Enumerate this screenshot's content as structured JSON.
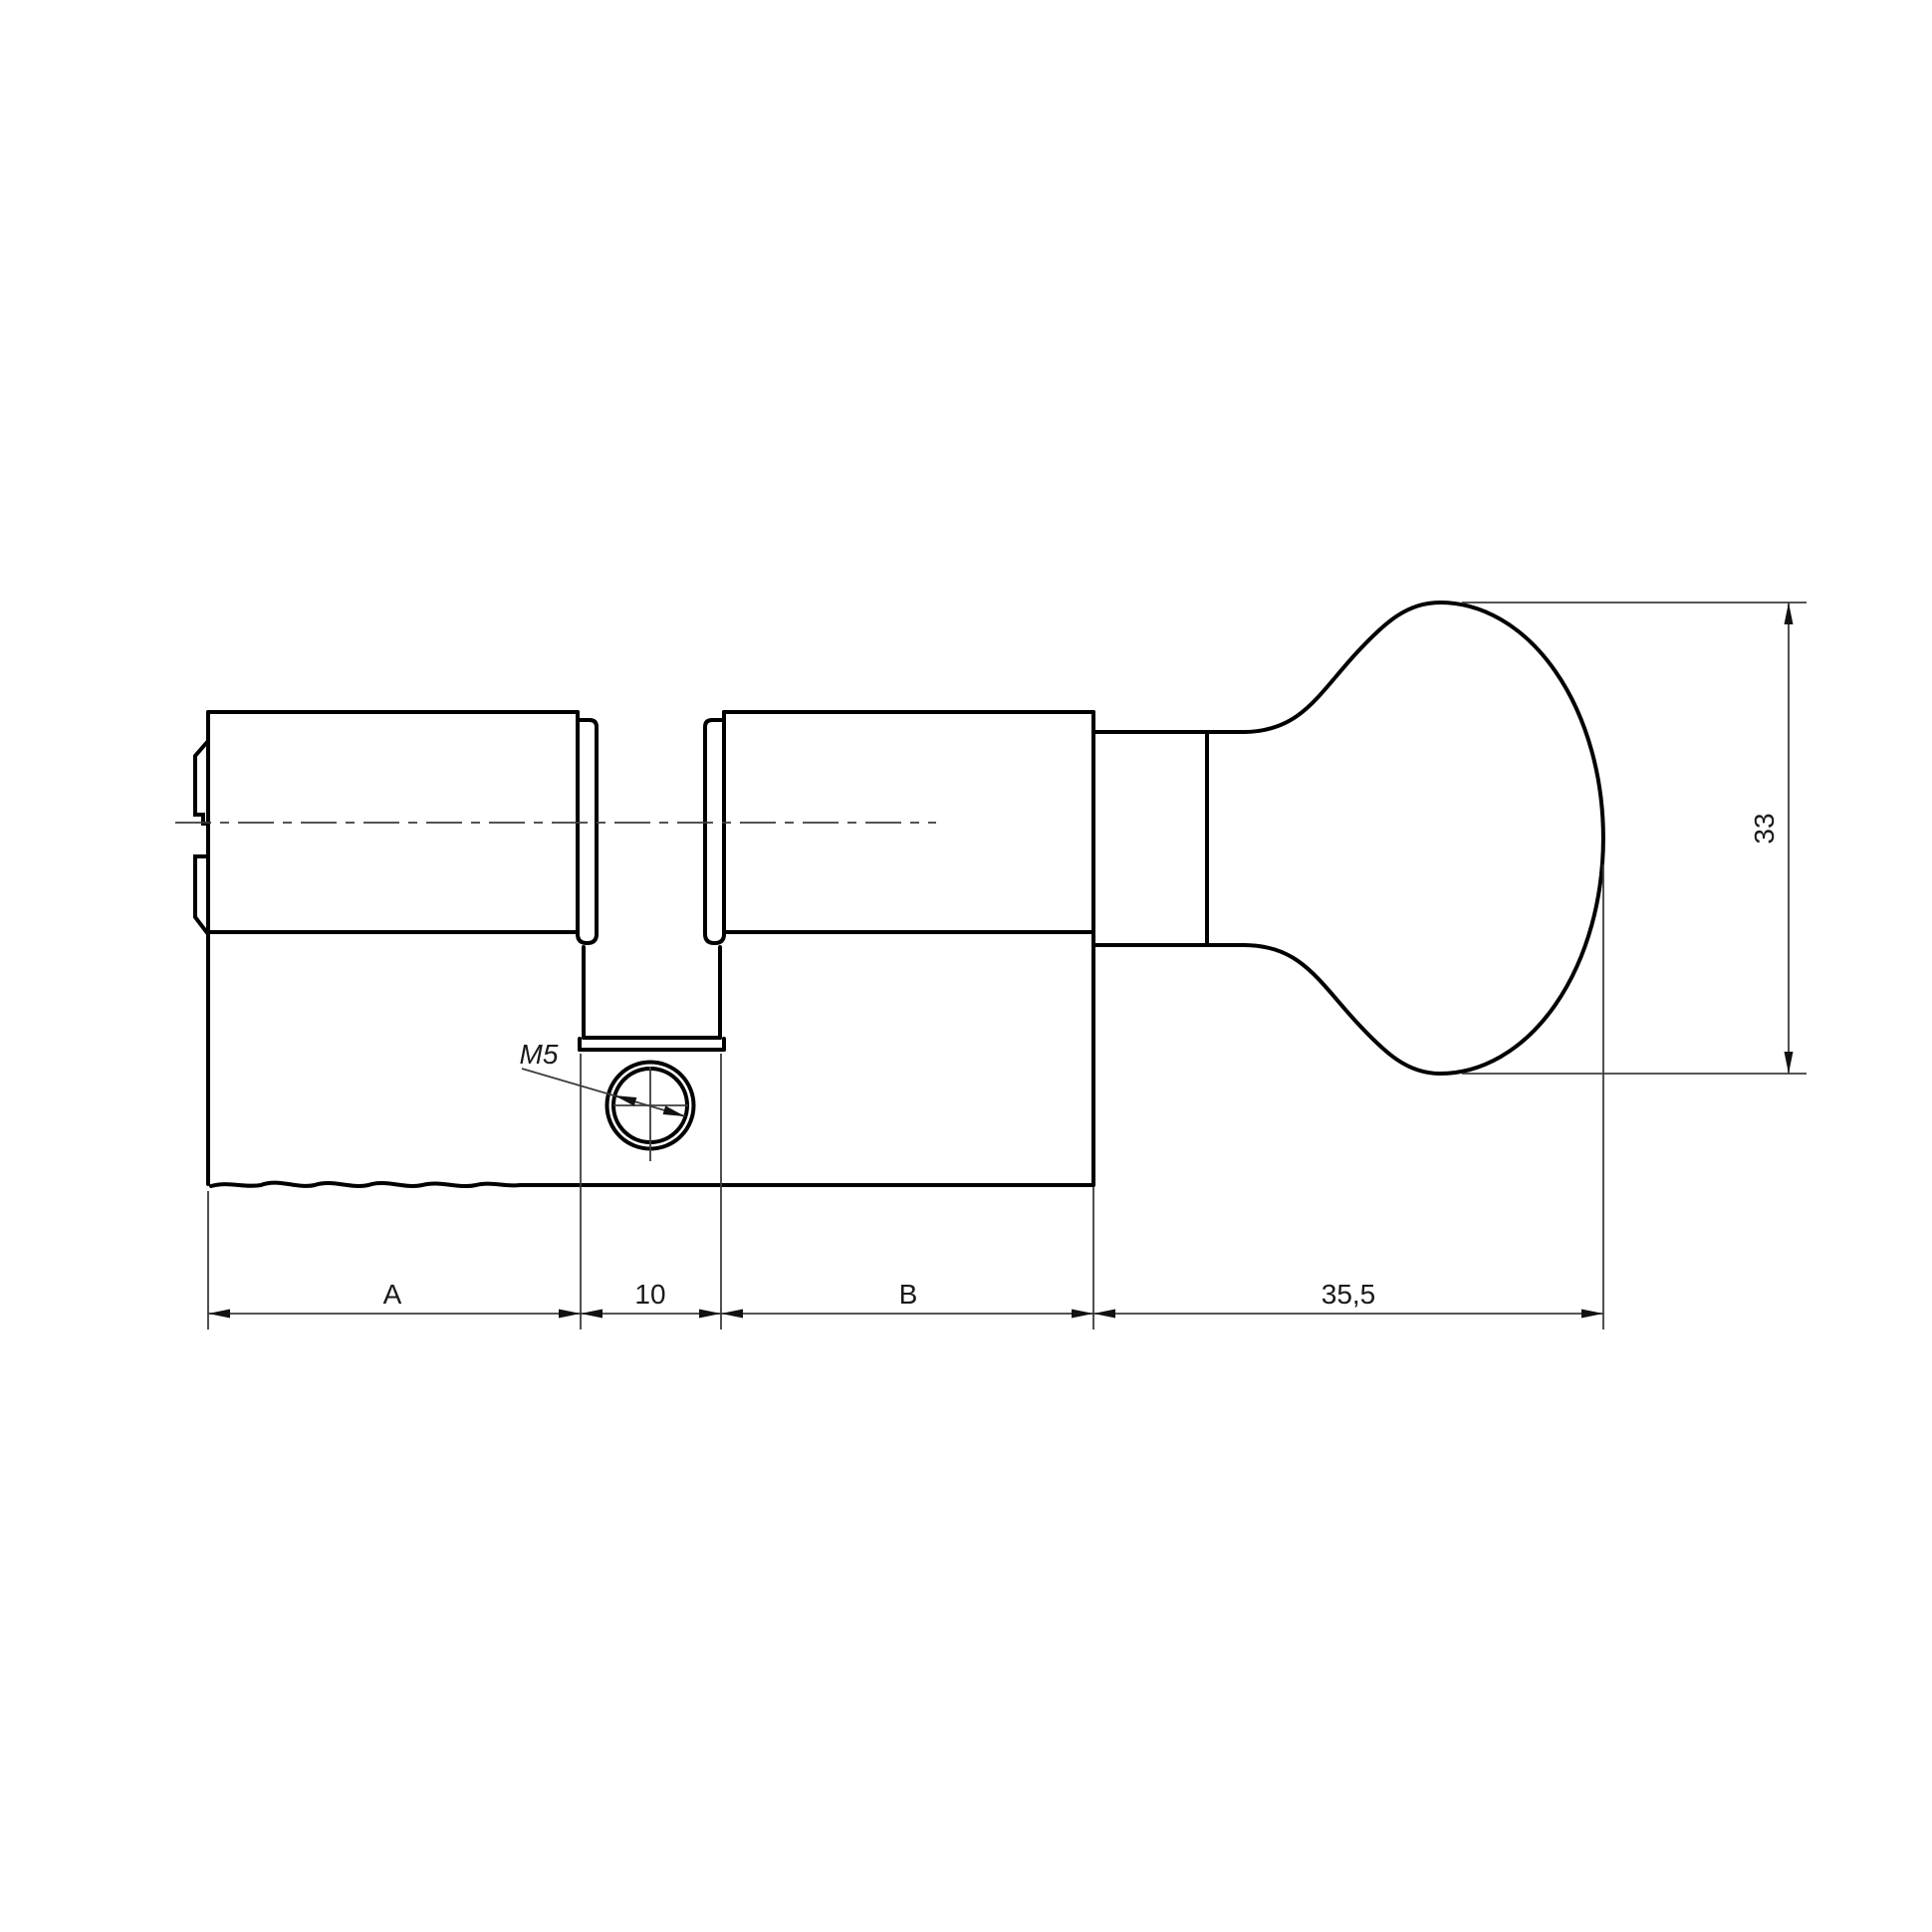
{
  "drawing": {
    "kind": "technical-drawing",
    "subject": "profile-cylinder-with-thumbturn",
    "background_color": "#ffffff",
    "outline_color": "#000000",
    "thin_line_color": "#3d3d3d",
    "text_color": "#1a1a1a",
    "labels": {
      "dim_a": "A",
      "dim_cam_width": "10",
      "dim_b": "B",
      "dim_knob_length": "35,5",
      "dim_knob_height": "33",
      "thread_callout": "M5"
    }
  }
}
